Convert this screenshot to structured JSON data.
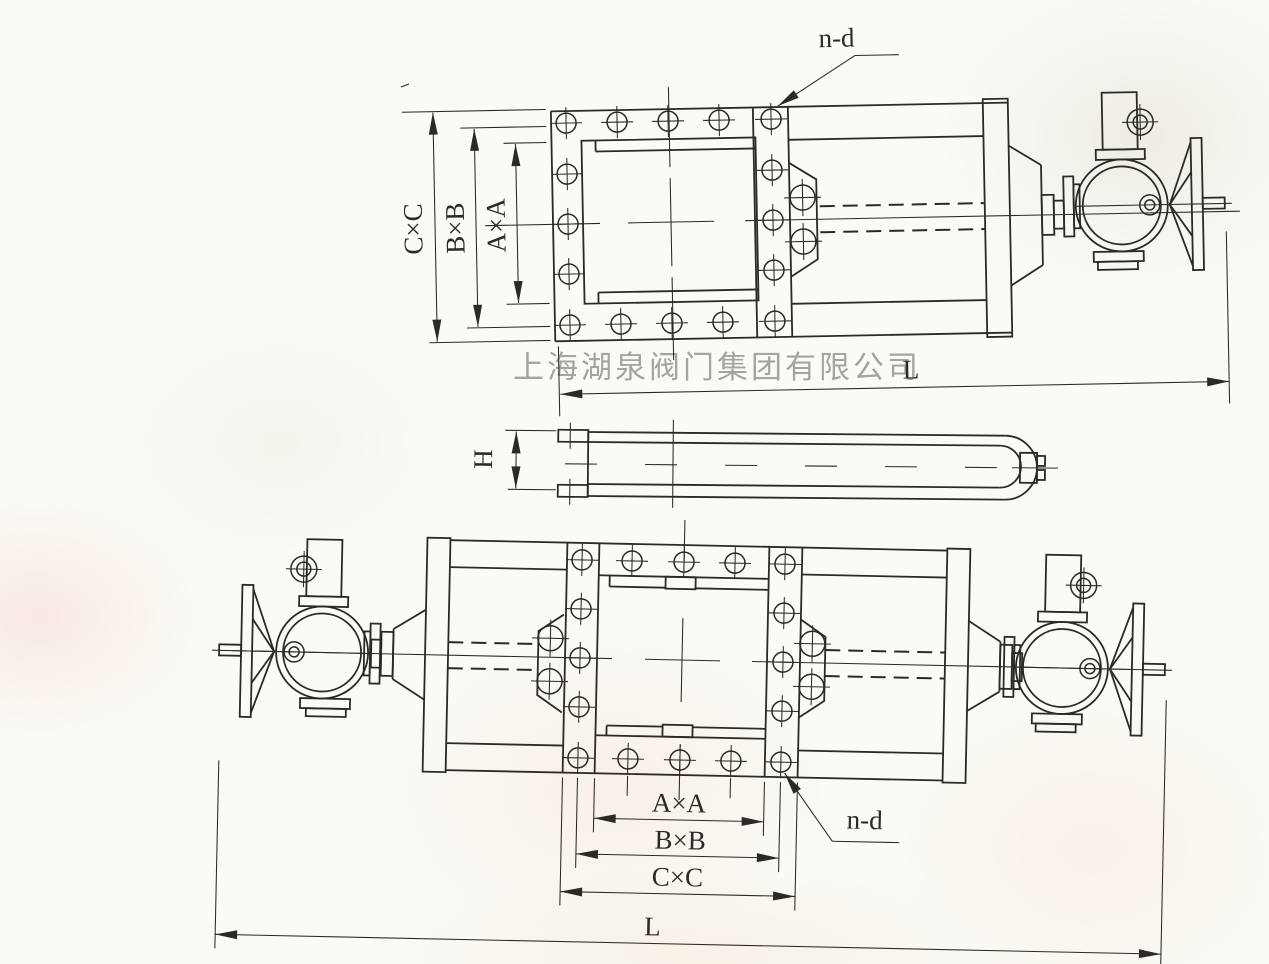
{
  "watermark": "上海湖泉阀门集团有限公司",
  "labels": {
    "top": {
      "cc": "C×C",
      "bb": "B×B",
      "aa": "A×A",
      "nd": "n-d",
      "length": "L"
    },
    "side": {
      "height": "H"
    },
    "bottom": {
      "aa": "A×A",
      "bb": "B×B",
      "cc": "C×C",
      "nd": "n-d",
      "length": "L"
    }
  },
  "colors": {
    "ink": "#2b2a26",
    "watermark": "#9b9996",
    "paper": "#fbfaf5"
  }
}
